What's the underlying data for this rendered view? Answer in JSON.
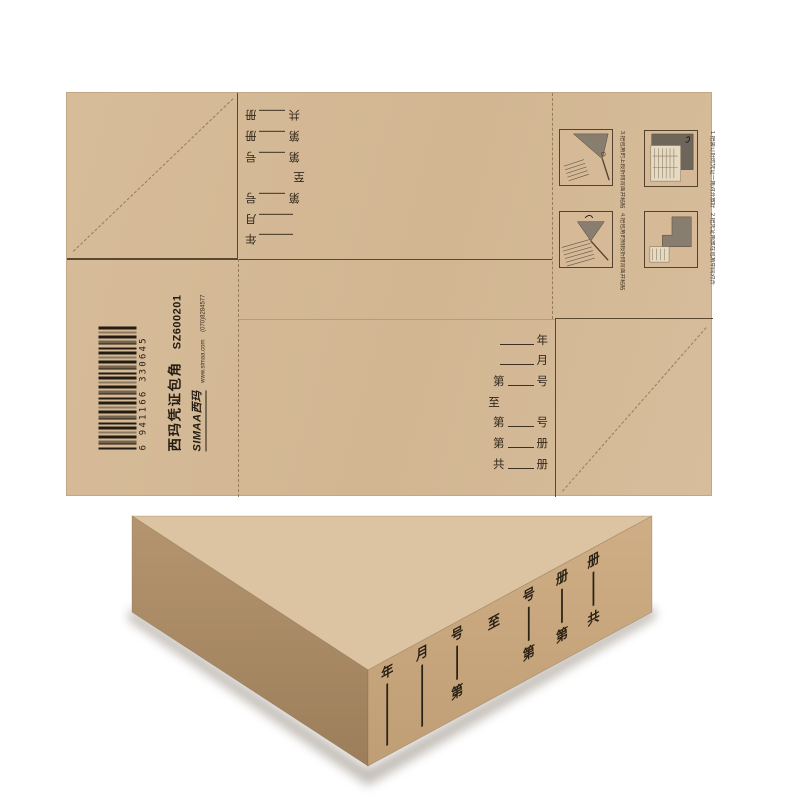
{
  "product": {
    "name": "西玛凭证包角",
    "code": "SZ600201",
    "barcode_digits": "6 941166 330645",
    "brand_logo": "SIMAA",
    "brand_cn": "西玛",
    "website": "www.simaa.com",
    "phone": "(070)8284577"
  },
  "colors": {
    "kraft": "#d4b896",
    "line_dark": "#5a4730",
    "dash": "#977b5a",
    "wedge_top_face": "#dcc4a2",
    "wedge_right_face": "#c9a880",
    "wedge_left_face": "#ab8c66",
    "ink": "#2a2115"
  },
  "fields": [
    {
      "prefix": "",
      "suffix": "年"
    },
    {
      "prefix": "",
      "suffix": "月"
    },
    {
      "prefix": "第",
      "suffix": "号"
    },
    {
      "prefix": "",
      "suffix": "至"
    },
    {
      "prefix": "第",
      "suffix": "号"
    },
    {
      "prefix": "第",
      "suffix": "册"
    },
    {
      "prefix": "共",
      "suffix": "册"
    }
  ],
  "instructions": {
    "steps": [
      {
        "num": "1",
        "caption": "1.把装订好的凭证一角对齐放好"
      },
      {
        "num": "2",
        "caption": "2.把凭证角放在包角中间对齐"
      },
      {
        "num": "3",
        "caption": "3.把包角的上段折向背面并粘贴"
      },
      {
        "num": "4",
        "caption": "4.把包角的侧段折向背面并粘贴"
      }
    ]
  }
}
